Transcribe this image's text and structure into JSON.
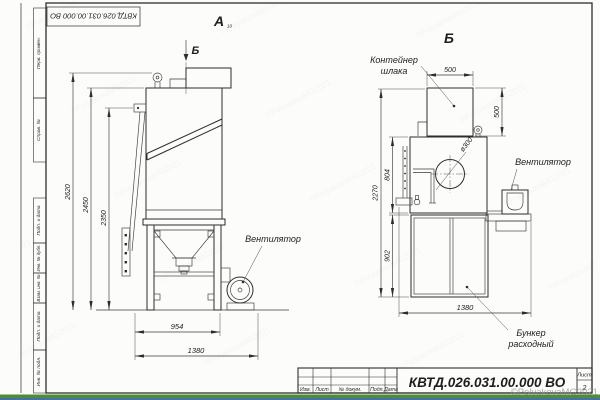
{
  "sheet": {
    "doc_number": "КВТД.026.031.00.000  ВО",
    "sheet_label": "Лист",
    "sheet_number": "2",
    "title_columns": [
      "Изм.",
      "Лист",
      "№ докум.",
      "Подп.",
      "Дата"
    ],
    "side_stamps": [
      "Перв. примен.",
      "Справ. №",
      "Подп. и дата",
      "Инв. № дубл.",
      "Взам. инв. №",
      "Подп. и дата",
      "Инв. № подл."
    ],
    "watermark": "©PolyakovaMG2021"
  },
  "views": {
    "a_label": "А",
    "a_sub": "10",
    "b_arrow_label": "Б",
    "b_title": "Б"
  },
  "labels": {
    "fan": "Вентилятор",
    "container_line1": "Контейнер",
    "container_line2": "шлака",
    "bunker_line1": "Бункер",
    "bunker_line2": "расходный"
  },
  "dims": {
    "h2620": "2620",
    "h2450": "2450",
    "h2350": "2350",
    "w954": "954",
    "w1380_left": "1380",
    "w500": "500",
    "h500": "500",
    "h804": "804",
    "h902": "902",
    "h2270": "2270",
    "w1380_right": "1380",
    "dia300": "ø300"
  }
}
